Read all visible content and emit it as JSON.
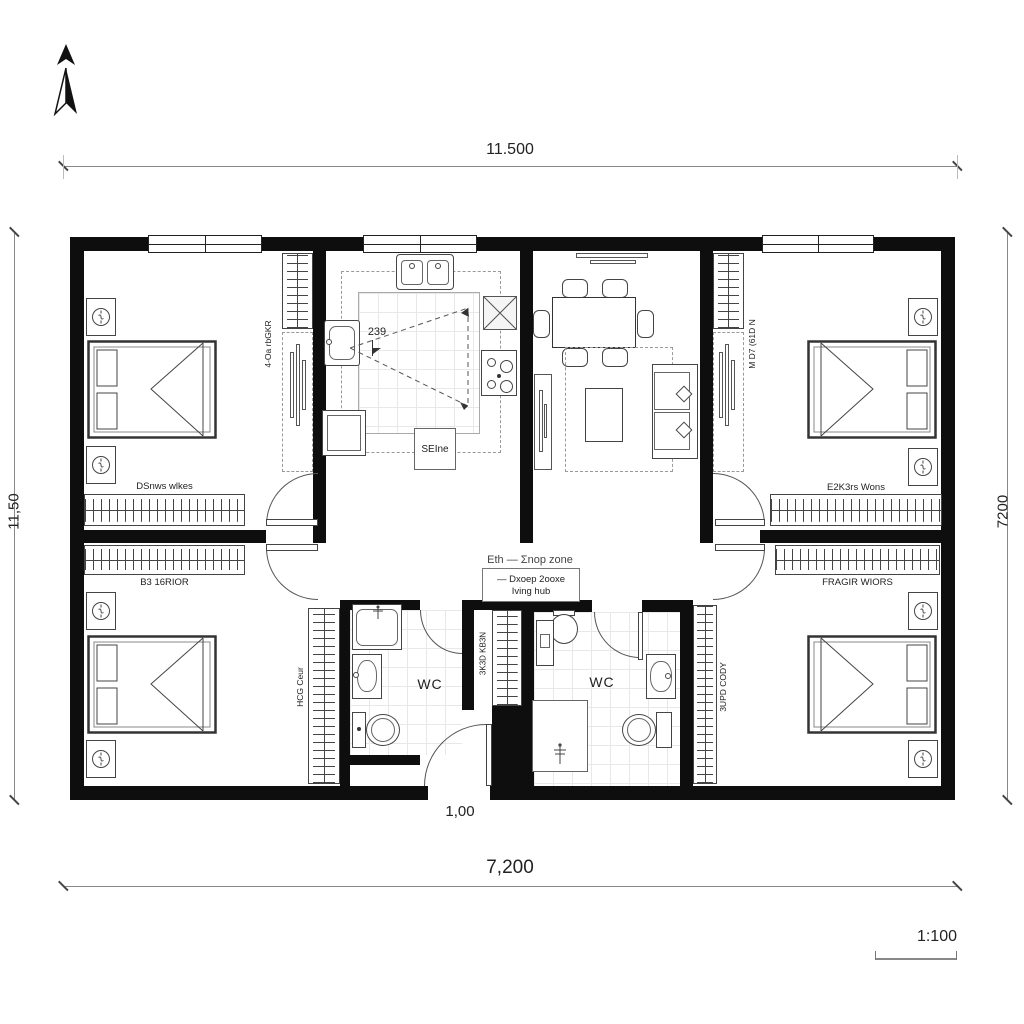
{
  "title_block": {
    "scale": "1:100"
  },
  "dimensions": {
    "top": "11.500",
    "bottom": "7,200",
    "left": "11,50",
    "right": "7200",
    "entry": "1,00",
    "kitchen": "239"
  },
  "rooms": {
    "wc_left": "WC",
    "wc_right": "WC",
    "kitchen_island": "SEIne",
    "hall": {
      "zone": "Eth — Σnop zone",
      "box_line1": "— Dxoep 2ooxe",
      "box_line2": "Iving hub"
    },
    "bedroom_tl": {
      "wardrobe": "DSnws wlkes",
      "closet": "4-Oa rbGKR"
    },
    "bedroom_tr": {
      "wardrobe": "E2K3rs Wons",
      "closet": "M D7 (61D N"
    },
    "bedroom_bl": {
      "wardrobe": "B3 16RIOR",
      "closet": "HCG Ceur"
    },
    "bedroom_br": {
      "wardrobe": "FRAGIR WIORS",
      "closet": "3UPD CODY"
    },
    "mid_closet": "3K3D KB3N"
  }
}
